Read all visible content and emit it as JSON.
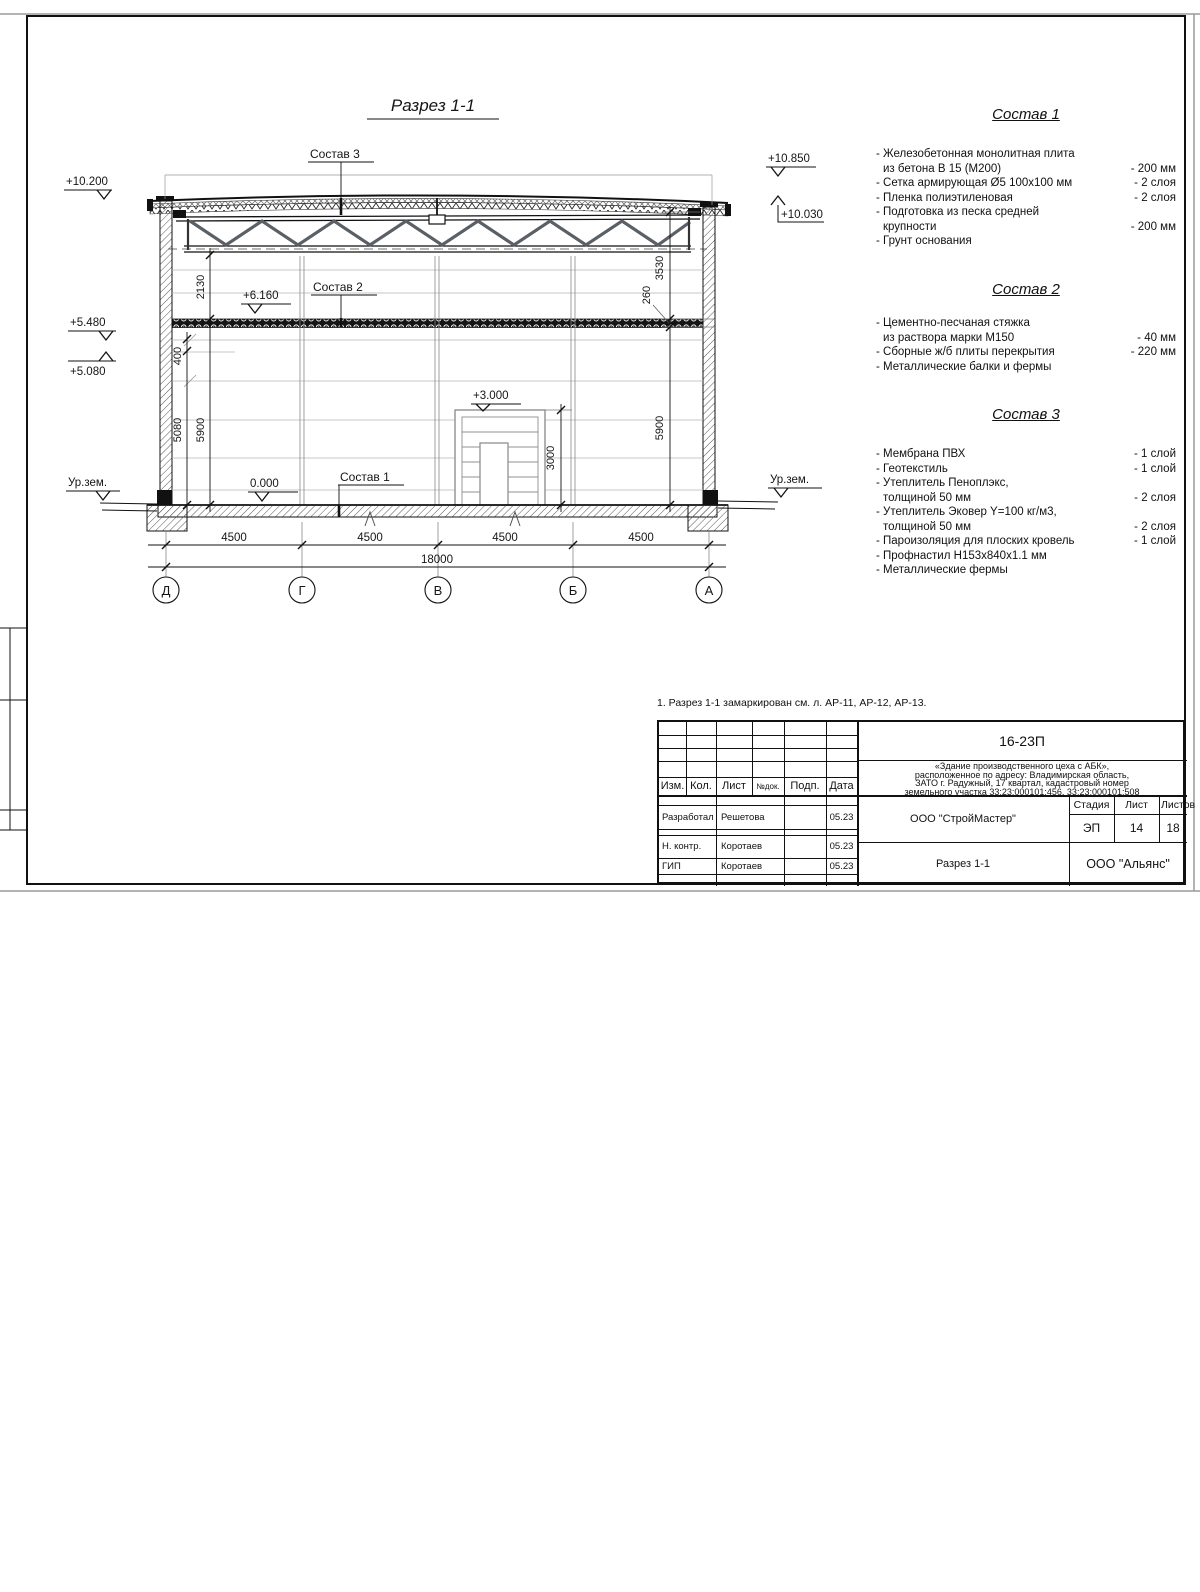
{
  "sheet": {
    "title": "Разрез 1-1",
    "note": "1. Разрез 1-1 замаркирован см. л. АР-11, АР-12, АР-13."
  },
  "marks": {
    "left_roof": "+10.200",
    "left_mid_upper": "+5.480",
    "left_mid_lower": "+5.080",
    "ground_left": "Ур.зем.",
    "zero": "0.000",
    "slab": "+6.160",
    "gate": "+3.000",
    "right_roof_top": "+10.850",
    "right_roof_low": "+10.030",
    "ground_right": "Ур.зем."
  },
  "layer_labels": {
    "s1": "Состав 1",
    "s2": "Состав 2",
    "s3": "Состав 3"
  },
  "dims": {
    "v400": "400",
    "v5080": "5080",
    "v5900l": "5900",
    "v2130": "2130",
    "v3530": "3530",
    "v260": "260",
    "v5900r": "5900",
    "v3000": "3000",
    "b1": "4500",
    "b2": "4500",
    "b3": "4500",
    "b4": "4500",
    "total": "18000"
  },
  "axes": [
    "Д",
    "Г",
    "В",
    "Б",
    "А"
  ],
  "compositions": [
    {
      "title": "Состав 1",
      "items": [
        {
          "l1": "- Железобетонная монолитная плита",
          "l2": "из бетона В 15 (М200)",
          "v": "- 200 мм"
        },
        {
          "l1": "- Сетка армирующая Ø5 100х100 мм",
          "v": "- 2 слоя"
        },
        {
          "l1": "- Пленка полиэтиленовая",
          "v": "- 2 слоя"
        },
        {
          "l1": "- Подготовка из песка средней",
          "l2": "крупности",
          "v": "- 200 мм"
        },
        {
          "l1": "- Грунт основания",
          "v": ""
        }
      ]
    },
    {
      "title": "Состав 2",
      "items": [
        {
          "l1": "- Цементно-песчаная стяжка",
          "l2": "из раствора марки М150",
          "v": "- 40 мм"
        },
        {
          "l1": "- Сборные ж/б плиты перекрытия",
          "v": "- 220 мм"
        },
        {
          "l1": "- Металлические балки и фермы",
          "v": ""
        }
      ]
    },
    {
      "title": "Состав 3",
      "items": [
        {
          "l1": "- Мембрана ПВХ",
          "v": "- 1 слой"
        },
        {
          "l1": "- Геотекстиль",
          "v": "- 1 слой"
        },
        {
          "l1": "- Утеплитель Пеноплэкс,",
          "l2": "толщиной 50 мм",
          "v": "- 2 слоя"
        },
        {
          "l1": "- Утеплитель Эковер Y=100 кг/м3,",
          "l2": "толщиной 50 мм",
          "v": "- 2 слоя"
        },
        {
          "l1": "- Пароизоляция для плоских кровель",
          "v": "- 1 слой"
        },
        {
          "l1": "- Профнастил Н153х840х1.1 мм",
          "v": ""
        },
        {
          "l1": "- Металлические фермы",
          "v": ""
        }
      ]
    }
  ],
  "title_block": {
    "code": "16-23П",
    "object_line1": "«Здание производственного цеха с АБК»,",
    "object_line2": "расположенное по адресу: Владимирская область,",
    "object_line3": "ЗАТО г. Радужный, 17 квартал, кадастровый номер",
    "object_line4": "земельного участка 33:23:000101:456, 33:23:000101:508",
    "cols": {
      "izm": "Изм.",
      "kol": "Кол.",
      "list": "Лист",
      "ndoc": "№док.",
      "podp": "Подп.",
      "data": "Дата"
    },
    "rows": [
      {
        "role": "Разработал",
        "name": "Решетова",
        "date": "05.23"
      },
      {
        "role": "Н. контр.",
        "name": "Коротаев",
        "date": "05.23"
      },
      {
        "role": "ГИП",
        "name": "Коротаев",
        "date": "05.23"
      }
    ],
    "org_designer": "ООО \"СтройМастер\"",
    "doc_title": "Разрез 1-1",
    "stage_label": "Стадия",
    "stage": "ЭП",
    "sheet_label": "Лист",
    "sheet_num": "14",
    "sheets_label": "Листов",
    "sheets_total": "18",
    "org_customer": "ООО \"Альянс\""
  }
}
